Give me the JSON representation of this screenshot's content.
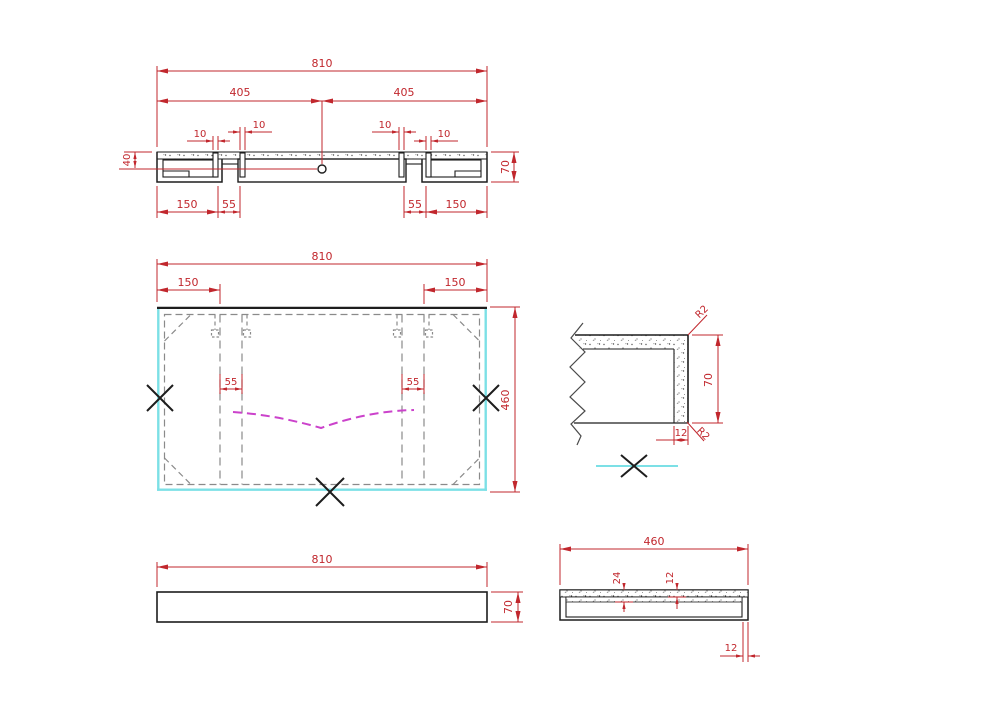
{
  "colors": {
    "dimension_red": "#c1272d",
    "outline_black": "#1d1d1d",
    "highlight_cyan": "#7ce0e6",
    "curve_magenta": "#cb42cb",
    "hidden_gray": "#8a8a8a"
  },
  "drawing": {
    "section_view": {
      "total_width": "810",
      "half_left": "405",
      "half_right": "405",
      "groove_1": "10",
      "groove_2": "10",
      "groove_3": "10",
      "groove_4": "10",
      "edge_depth": "40",
      "thickness": "70",
      "bottom_150_left": "150",
      "bottom_55_left": "55",
      "bottom_55_right": "55",
      "bottom_150_right": "150"
    },
    "plan_view": {
      "total_width": "810",
      "left_offset": "150",
      "right_offset": "150",
      "groove_left": "55",
      "groove_right": "55",
      "depth": "460"
    },
    "corner_detail": {
      "radius_top": "R2",
      "height": "70",
      "wall_thickness": "12",
      "radius_bottom": "R2"
    },
    "front_view": {
      "width": "810",
      "height": "70"
    },
    "side_view": {
      "width": "460",
      "lip_depth": "24",
      "slab_thickness": "12",
      "wall_thickness": "12"
    }
  }
}
